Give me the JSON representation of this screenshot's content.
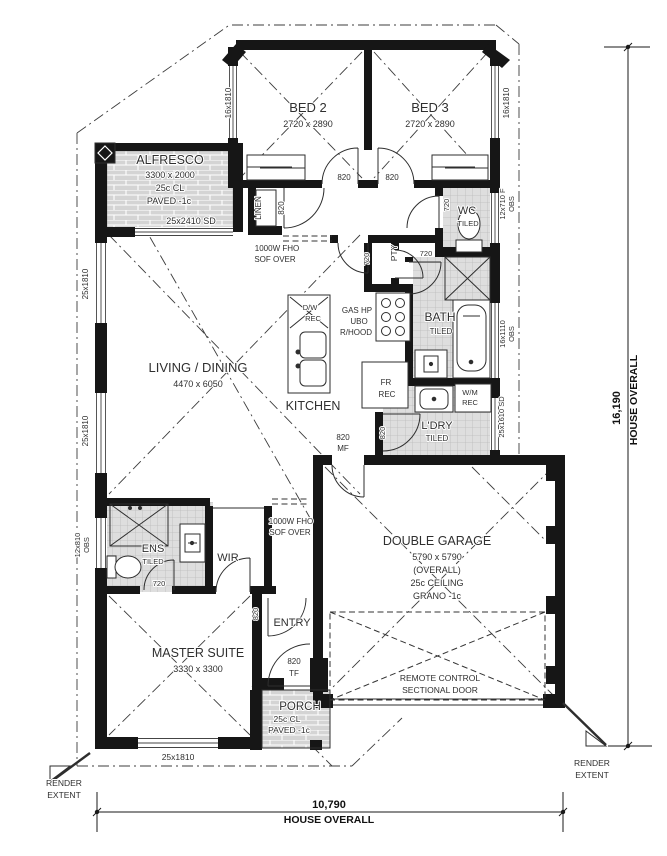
{
  "drawing": {
    "kind": "residential floor plan",
    "overall_width": "10,790",
    "overall_height": "16,190",
    "overall_caption": "HOUSE OVERALL"
  },
  "colors": {
    "wall": "#161616",
    "paving": "#d4d4d4",
    "tile": "#dedede",
    "line": "#2e2e2e",
    "background": "#ffffff"
  },
  "rooms": [
    {
      "name": "BED 2",
      "dims": "2720 x 2890"
    },
    {
      "name": "BED 3",
      "dims": "2720 x 2890"
    },
    {
      "name": "ALFRESCO",
      "dims": "3300 x 2000",
      "notes": "25c CL, PAVED -1c"
    },
    {
      "name": "LIVING / DINING",
      "dims": "4470 x 6050"
    },
    {
      "name": "KITCHEN"
    },
    {
      "name": "WC",
      "notes": "TILED"
    },
    {
      "name": "BATH",
      "notes": "TILED"
    },
    {
      "name": "L'DRY",
      "notes": "TILED"
    },
    {
      "name": "DOUBLE GARAGE",
      "dims": "5790 x 5790",
      "notes": "(OVERALL), 25c CEILING, GRANO -1c"
    },
    {
      "name": "ENS",
      "notes": "TILED"
    },
    {
      "name": "WIR"
    },
    {
      "name": "ENTRY"
    },
    {
      "name": "MASTER SUITE",
      "dims": "3330 x 3300"
    },
    {
      "name": "PORCH",
      "notes": "25c CL, PAVED -1c"
    }
  ],
  "labels": [
    {
      "name": "room-bed2-name",
      "text": "BED 2",
      "x": 308,
      "y": 112,
      "size": 13
    },
    {
      "name": "room-bed2-dims",
      "text": "2720 x 2890",
      "x": 308,
      "y": 127,
      "size": 9
    },
    {
      "name": "room-bed3-name",
      "text": "BED 3",
      "x": 430,
      "y": 112,
      "size": 13
    },
    {
      "name": "room-bed3-dims",
      "text": "2720 x 2890",
      "x": 430,
      "y": 127,
      "size": 9
    },
    {
      "name": "window-bed2-label",
      "text": "16x1810",
      "x": 231,
      "y": 103,
      "size": 8,
      "rot": -90
    },
    {
      "name": "window-bed3-label",
      "text": "16x1810",
      "x": 509,
      "y": 103,
      "size": 8,
      "rot": -90
    },
    {
      "name": "door-bed2-label",
      "text": "820",
      "x": 344,
      "y": 180,
      "size": 8
    },
    {
      "name": "door-bed3-label",
      "text": "820",
      "x": 392,
      "y": 180,
      "size": 8
    },
    {
      "name": "linen-label",
      "text": "LINEN",
      "x": 261,
      "y": 208,
      "size": 8,
      "rot": -90
    },
    {
      "name": "door-linen-label",
      "text": "820",
      "x": 284,
      "y": 208,
      "size": 8,
      "rot": -90
    },
    {
      "name": "room-wc-name",
      "text": "WC",
      "x": 467,
      "y": 214,
      "size": 11
    },
    {
      "name": "room-wc-finish",
      "text": "TILED",
      "x": 468,
      "y": 226,
      "size": 7.5
    },
    {
      "name": "door-wc-label",
      "text": "720",
      "x": 449,
      "y": 205,
      "size": 7.5,
      "rot": -90
    },
    {
      "name": "window-wc-label-1",
      "text": "12x710 F",
      "x": 505,
      "y": 204,
      "size": 7.5,
      "rot": -90
    },
    {
      "name": "window-wc-label-2",
      "text": "OBS",
      "x": 514,
      "y": 204,
      "size": 7.5,
      "rot": -90
    },
    {
      "name": "room-alfresco-name",
      "text": "ALFRESCO",
      "x": 170,
      "y": 164,
      "size": 12.5
    },
    {
      "name": "room-alfresco-dims",
      "text": "3300 x 2000",
      "x": 170,
      "y": 178,
      "size": 9
    },
    {
      "name": "room-alfresco-ceiling",
      "text": "25c CL",
      "x": 170,
      "y": 191,
      "size": 9
    },
    {
      "name": "room-alfresco-finish",
      "text": "PAVED -1c",
      "x": 169,
      "y": 204,
      "size": 9
    },
    {
      "name": "door-alfresco-sd-label",
      "text": "25x2410 SD",
      "x": 191,
      "y": 224,
      "size": 9
    },
    {
      "name": "bulkhead-kitchen-label-1",
      "text": "1000W FHO",
      "x": 277,
      "y": 251,
      "size": 8
    },
    {
      "name": "bulkhead-kitchen-label-2",
      "text": "SOF OVER",
      "x": 275,
      "y": 262,
      "size": 8
    },
    {
      "name": "door-kitchen-label",
      "text": "720",
      "x": 369,
      "y": 259,
      "size": 7.5,
      "rot": -90
    },
    {
      "name": "pantry-label",
      "text": "PTY",
      "x": 397,
      "y": 253,
      "size": 8.5,
      "rot": -90
    },
    {
      "name": "door-bath-label",
      "text": "720",
      "x": 426,
      "y": 256,
      "size": 7.5
    },
    {
      "name": "kitchen-dw-label-1",
      "text": "D/W",
      "x": 310,
      "y": 310,
      "size": 7.5
    },
    {
      "name": "kitchen-dw-label-2",
      "text": "REC",
      "x": 313,
      "y": 321,
      "size": 7.5
    },
    {
      "name": "kitchen-appliance-label-1",
      "text": "GAS HP",
      "x": 357,
      "y": 313,
      "size": 8
    },
    {
      "name": "kitchen-appliance-label-2",
      "text": "UBO",
      "x": 359,
      "y": 324,
      "size": 8
    },
    {
      "name": "kitchen-appliance-label-3",
      "text": "R/HOOD",
      "x": 356,
      "y": 335,
      "size": 8
    },
    {
      "name": "room-bath-name",
      "text": "BATH",
      "x": 440,
      "y": 321,
      "size": 12
    },
    {
      "name": "room-bath-finish",
      "text": "TILED",
      "x": 441,
      "y": 334,
      "size": 8
    },
    {
      "name": "window-bath-label-1",
      "text": "16x1110",
      "x": 505,
      "y": 334,
      "size": 7.5,
      "rot": -90
    },
    {
      "name": "window-bath-label-2",
      "text": "OBS",
      "x": 514,
      "y": 334,
      "size": 7.5,
      "rot": -90
    },
    {
      "name": "room-living-name",
      "text": "LIVING / DINING",
      "x": 198,
      "y": 372,
      "size": 13
    },
    {
      "name": "room-living-dims",
      "text": "4470 x 6050",
      "x": 198,
      "y": 387,
      "size": 9
    },
    {
      "name": "room-kitchen-name",
      "text": "KITCHEN",
      "x": 313,
      "y": 410,
      "size": 12.5
    },
    {
      "name": "fridge-recess-label-1",
      "text": "FR",
      "x": 386,
      "y": 385,
      "size": 8
    },
    {
      "name": "fridge-recess-label-2",
      "text": "REC",
      "x": 387,
      "y": 397,
      "size": 8
    },
    {
      "name": "washing-machine-label-1",
      "text": "W/M",
      "x": 470,
      "y": 395,
      "size": 7.5
    },
    {
      "name": "washing-machine-label-2",
      "text": "REC",
      "x": 470,
      "y": 405,
      "size": 7.5
    },
    {
      "name": "room-laundry-name",
      "text": "L'DRY",
      "x": 437,
      "y": 429,
      "size": 11
    },
    {
      "name": "room-laundry-finish",
      "text": "TILED",
      "x": 437,
      "y": 441,
      "size": 8
    },
    {
      "name": "door-laundry-label",
      "text": "820",
      "x": 385,
      "y": 433,
      "size": 7.5,
      "rot": -90
    },
    {
      "name": "door-garage-entry-label-1",
      "text": "820",
      "x": 343,
      "y": 440,
      "size": 8
    },
    {
      "name": "door-garage-entry-label-2",
      "text": "MF",
      "x": 343,
      "y": 451,
      "size": 8
    },
    {
      "name": "door-laundry-sd-label",
      "text": "25x1610 SD",
      "x": 504,
      "y": 417,
      "size": 7.5,
      "rot": -90
    },
    {
      "name": "room-garage-name",
      "text": "DOUBLE GARAGE",
      "x": 437,
      "y": 545,
      "size": 12.5
    },
    {
      "name": "room-garage-dims",
      "text": "5790 x 5790",
      "x": 437,
      "y": 560,
      "size": 9
    },
    {
      "name": "room-garage-note-1",
      "text": "(OVERALL)",
      "x": 437,
      "y": 573,
      "size": 9
    },
    {
      "name": "room-garage-note-2",
      "text": "25c CEILING",
      "x": 437,
      "y": 586,
      "size": 9
    },
    {
      "name": "room-garage-note-3",
      "text": "GRANO -1c",
      "x": 437,
      "y": 599,
      "size": 9
    },
    {
      "name": "garage-door-label-1",
      "text": "REMOTE CONTROL",
      "x": 440,
      "y": 681,
      "size": 8.5
    },
    {
      "name": "garage-door-label-2",
      "text": "SECTIONAL DOOR",
      "x": 440,
      "y": 693,
      "size": 8.5
    },
    {
      "name": "room-ens-name",
      "text": "ENS",
      "x": 153,
      "y": 552,
      "size": 11
    },
    {
      "name": "room-ens-finish",
      "text": "TILED",
      "x": 153,
      "y": 564,
      "size": 7.5
    },
    {
      "name": "door-ens-label",
      "text": "720",
      "x": 159,
      "y": 586,
      "size": 7.5
    },
    {
      "name": "room-wir-name",
      "text": "WIR",
      "x": 228,
      "y": 561,
      "size": 11
    },
    {
      "name": "bulkhead-entry-label-1",
      "text": "1000W FHO",
      "x": 291,
      "y": 524,
      "size": 8
    },
    {
      "name": "bulkhead-entry-label-2",
      "text": "SOF OVER",
      "x": 290,
      "y": 535,
      "size": 8
    },
    {
      "name": "room-entry-name",
      "text": "ENTRY",
      "x": 292,
      "y": 626,
      "size": 11
    },
    {
      "name": "door-entry-label",
      "text": "820",
      "x": 258,
      "y": 614,
      "size": 7.5,
      "rot": -90
    },
    {
      "name": "room-master-name",
      "text": "MASTER SUITE",
      "x": 198,
      "y": 657,
      "size": 12.5
    },
    {
      "name": "room-master-dims",
      "text": "3330 x 3300",
      "x": 198,
      "y": 672,
      "size": 9
    },
    {
      "name": "door-front-label-1",
      "text": "820",
      "x": 294,
      "y": 664,
      "size": 8
    },
    {
      "name": "door-front-label-2",
      "text": "TF",
      "x": 294,
      "y": 676,
      "size": 8
    },
    {
      "name": "room-porch-name",
      "text": "PORCH",
      "x": 300,
      "y": 710,
      "size": 11.5
    },
    {
      "name": "room-porch-ceiling",
      "text": "25c CL",
      "x": 287,
      "y": 722,
      "size": 8.5
    },
    {
      "name": "room-porch-finish",
      "text": "PAVED -1c",
      "x": 289,
      "y": 733,
      "size": 8.5
    },
    {
      "name": "window-master-front-label",
      "text": "25x1810",
      "x": 178,
      "y": 760,
      "size": 8.5
    },
    {
      "name": "window-living-label-1",
      "text": "25x1810",
      "x": 88,
      "y": 284,
      "size": 8,
      "rot": -90
    },
    {
      "name": "window-living-label-2",
      "text": "25x1810",
      "x": 88,
      "y": 431,
      "size": 8,
      "rot": -90
    },
    {
      "name": "window-ens-label-1",
      "text": "12x810",
      "x": 80,
      "y": 545,
      "size": 7.5,
      "rot": -90
    },
    {
      "name": "window-ens-label-2",
      "text": "OBS",
      "x": 89,
      "y": 545,
      "size": 7.5,
      "rot": -90
    },
    {
      "name": "render-extent-left-1",
      "text": "RENDER",
      "x": 64,
      "y": 786,
      "size": 8.5
    },
    {
      "name": "render-extent-left-2",
      "text": "EXTENT",
      "x": 64,
      "y": 798,
      "size": 8.5
    },
    {
      "name": "render-extent-right-1",
      "text": "RENDER",
      "x": 592,
      "y": 766,
      "size": 8.5
    },
    {
      "name": "render-extent-right-2",
      "text": "EXTENT",
      "x": 592,
      "y": 778,
      "size": 8.5
    },
    {
      "name": "dim-width-value",
      "text": "10,790",
      "x": 329,
      "y": 808,
      "size": 11,
      "weight": "bold"
    },
    {
      "name": "dim-width-caption",
      "text": "HOUSE OVERALL",
      "x": 329,
      "y": 823,
      "size": 10.5,
      "weight": "bold"
    },
    {
      "name": "dim-height-value",
      "text": "16,190",
      "x": 620,
      "y": 408,
      "size": 11,
      "rot": -90,
      "weight": "bold"
    },
    {
      "name": "dim-height-caption",
      "text": "HOUSE OVERALL",
      "x": 637,
      "y": 400,
      "size": 10.5,
      "rot": -90,
      "weight": "bold"
    }
  ]
}
